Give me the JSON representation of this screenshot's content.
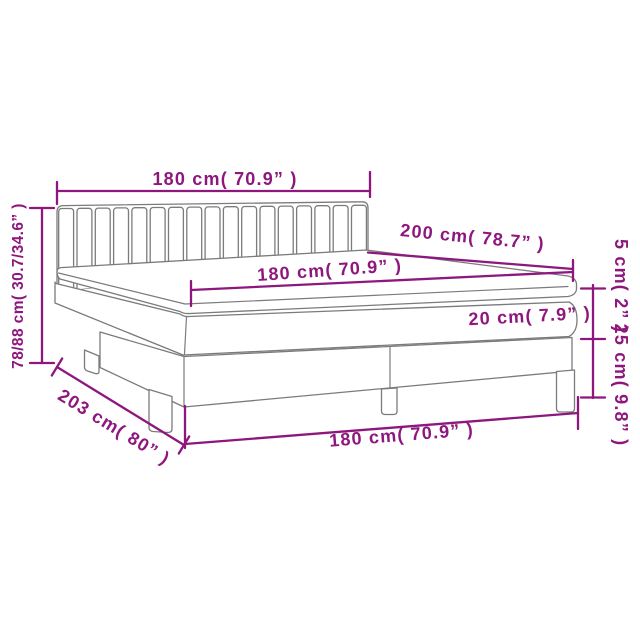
{
  "diagram": {
    "type": "product-dimension-diagram",
    "subject": "box-spring-bed-with-headboard-topper-mattress-and-base",
    "colors": {
      "dimension_accent": "#8e177e",
      "product_outline": "#7b7b7b",
      "background": "#ffffff"
    },
    "labels": {
      "headboard_width": "180 cm( 70.9” )",
      "total_height": "78/88 cm( 30.7/34.6” )",
      "mattress_length": "200 cm( 78.7” )",
      "mattress_width": "180 cm( 70.9” )",
      "mattress_thickness": "20 cm( 7.9” )",
      "topper_thickness": "5 cm( 2” )",
      "base_height": "25 cm( 9.8” )",
      "base_length": "203 cm( 80” )",
      "base_width": "180 cm( 70.9” )"
    }
  }
}
